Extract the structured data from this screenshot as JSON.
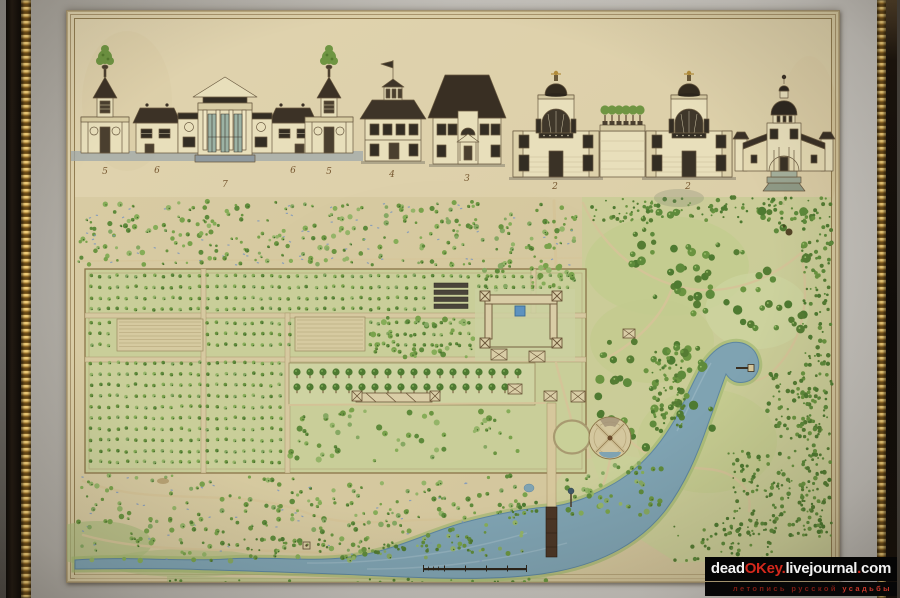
{
  "artwork": {
    "elevation_labels": [
      "5",
      "6",
      "7",
      "6",
      "5",
      "4",
      "3",
      "2",
      "2",
      "1"
    ]
  },
  "palette": {
    "paper": "#d9cca5",
    "mat": "#c2bfb9",
    "frame": "#17110c",
    "gold_beading": "#d9a94e",
    "tree_green": "#79a24b",
    "water_blue": "#7fa3b2",
    "roof_dark": "#3c3226",
    "wall_cream": "#e8dfbb"
  },
  "watermark": {
    "site_prefix": "dead",
    "site_accent": "OKey",
    "dot": ".",
    "site_mid": "livejournal",
    "site_tld": "com",
    "tagline_main": "летопись русской",
    "tagline_accent": "усадьбы",
    "accent_color": "#d3281c"
  }
}
